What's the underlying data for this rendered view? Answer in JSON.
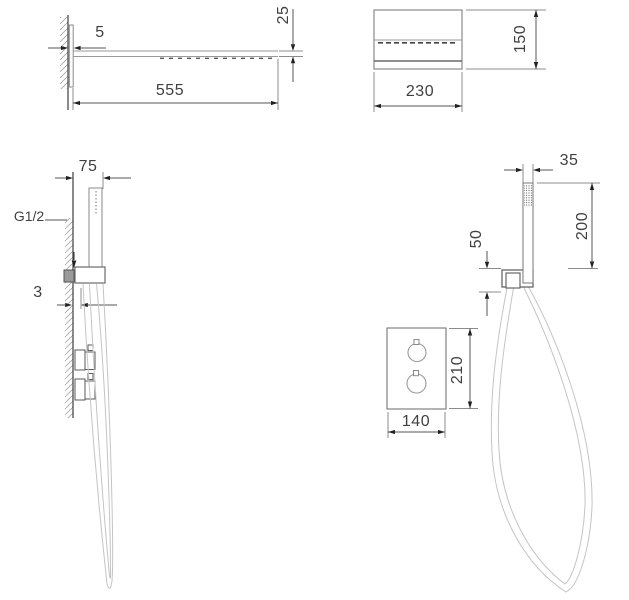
{
  "page": {
    "background": "#ffffff",
    "line_color": "#4a4a4a",
    "dim_color": "#555555"
  },
  "views": {
    "head_side": {
      "label": "rain shower head - side view",
      "dims": {
        "plate_thickness": "5",
        "length": "555",
        "height": "25"
      }
    },
    "head_front": {
      "label": "rain shower head - front view",
      "dims": {
        "width": "230",
        "height": "150"
      }
    },
    "handset_side": {
      "label": "hand shower - side view",
      "dims": {
        "offset": "75",
        "connection": "G1/2",
        "wall_gap": "3"
      }
    },
    "handset_front": {
      "label": "hand shower - front view",
      "dims": {
        "width": "35",
        "length": "200",
        "outlet_height": "50"
      }
    },
    "mixer_front": {
      "label": "thermostatic mixer - front view",
      "dims": {
        "width": "140",
        "height": "210"
      }
    }
  }
}
